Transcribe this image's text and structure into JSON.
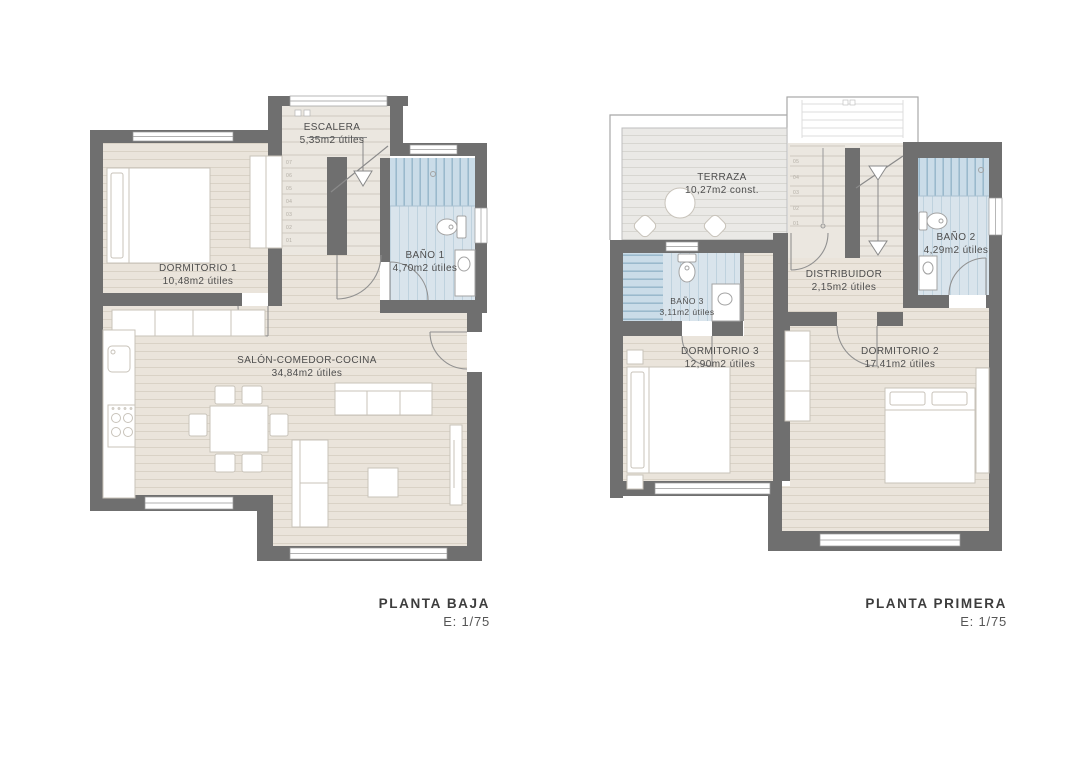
{
  "sheet": {
    "background": "#ffffff"
  },
  "colors": {
    "wall": "#6f6f6f",
    "wood_floor": "#eae4db",
    "wood_line": "#d9d2c6",
    "stair_floor": "#ebe7e0",
    "bath_floor": "#d9e4ec",
    "bath_line": "#bfd2de",
    "shower_floor": "#cadce8",
    "shower_line": "#97b7ca",
    "terrace_floor": "#eae9e6",
    "terrace_line": "#d7d6d1",
    "furniture_stroke": "#c8c3ba",
    "door_stroke": "#919191",
    "label_text": "#4e4e4e",
    "title_text": "#3d3d3d"
  },
  "plans": [
    {
      "id": "planta-baja",
      "title": "PLANTA BAJA",
      "scale": "E: 1/75",
      "rooms": [
        {
          "name": "ESCALERA",
          "area": "5,35m2 útiles"
        },
        {
          "name": "DORMITORIO 1",
          "area": "10,48m2 útiles"
        },
        {
          "name": "BAÑO 1",
          "area": "4,70m2 útiles"
        },
        {
          "name": "SALÓN-COMEDOR-COCINA",
          "area": "34,84m2 útiles"
        }
      ],
      "stair_steps": [
        "01",
        "02",
        "03",
        "04",
        "05",
        "06",
        "07"
      ]
    },
    {
      "id": "planta-primera",
      "title": "PLANTA PRIMERA",
      "scale": "E: 1/75",
      "rooms": [
        {
          "name": "TERRAZA",
          "area": "10,27m2 const."
        },
        {
          "name": "BAÑO 2",
          "area": "4,29m2 útiles"
        },
        {
          "name": "BAÑO 3",
          "area": "3,11m2 útiles"
        },
        {
          "name": "DISTRIBUIDOR",
          "area": "2,15m2 útiles"
        },
        {
          "name": "DORMITORIO 3",
          "area": "12,90m2 útiles"
        },
        {
          "name": "DORMITORIO 2",
          "area": "17,41m2 útiles"
        }
      ],
      "stair_steps": [
        "01",
        "02",
        "03",
        "04",
        "05"
      ]
    }
  ]
}
